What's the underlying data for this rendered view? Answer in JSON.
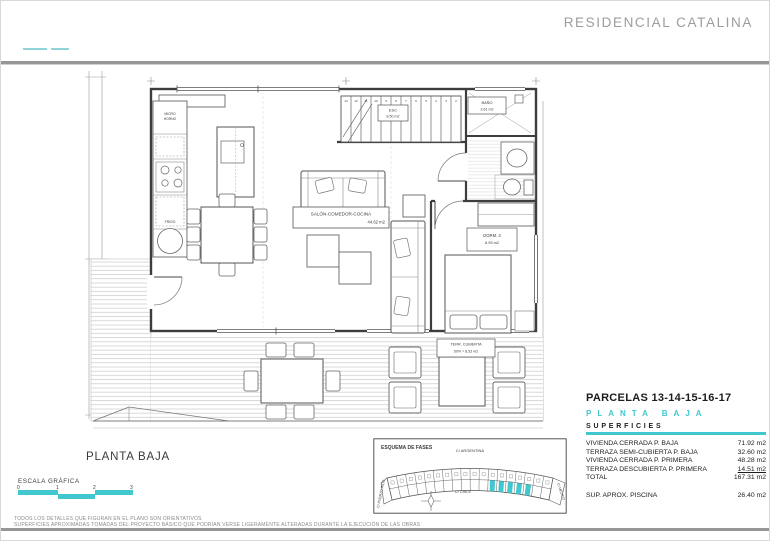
{
  "header": {
    "title": "RESIDENCIAL CATALINA"
  },
  "plan": {
    "salon": {
      "name": "SALÓN-COMEDOR-COCINA",
      "area": "44.62 m2"
    },
    "esc": {
      "name": "ESC",
      "area": "8.50 m2"
    },
    "bano": {
      "name": "BAÑO",
      "area": "3.61 m2"
    },
    "dorm": {
      "name": "DORM. 3",
      "area": "8.93 m2"
    },
    "terraza": {
      "name": "TERR. CUBIERTA",
      "area": "50% = 8.53 m2"
    },
    "micro_line1": "MICRO",
    "micro_line2": "HORNO",
    "frigo": "FRIGO",
    "stair_numbers": [
      "13",
      "12",
      "11",
      "10",
      "9",
      "8",
      "7",
      "6",
      "5",
      "4",
      "3",
      "2"
    ]
  },
  "footer": {
    "plan_title": "PLANTA BAJA",
    "scale_label": "ESCALA GRÁFICA",
    "scale_ticks": [
      "0",
      "1",
      "2",
      "3"
    ]
  },
  "esquema": {
    "title": "ESQUEMA DE FASES",
    "street_top": "C/ ARGENTINA",
    "street_bottom": "C/ CHILE",
    "street_left": "C/ PUERTO RICO",
    "street_right": "C/ MEJICO"
  },
  "summary": {
    "title": "PARCELAS 13-14-15-16-17",
    "subtitle": "PLANTA BAJA",
    "section": "SUPERFICIES",
    "rows": [
      {
        "label": "VIVIENDA CERRADA P. BAJA",
        "value": "71.92 m2"
      },
      {
        "label": "TERRAZA SEMI-CUBIERTA P. BAJA",
        "value": "32.60 m2"
      },
      {
        "label": "VIVIENDA CERRADA P. PRIMERA",
        "value": "48.28 m2"
      },
      {
        "label": "TERRAZA DESCUBIERTA P. PRIMERA",
        "value": "14.51 m2"
      },
      {
        "label": "TOTAL",
        "value": "167.31 m2"
      }
    ],
    "extra_row": {
      "label": "SUP. APROX. PISCINA",
      "value": "26.40 m2"
    }
  },
  "disclaimer": {
    "line1": "TODOS LOS DETALLES QUE FIGURAN EN EL PLANO SON ORIENTATIVOS",
    "line2": "SUPERFICIES APROXIMADAS TOMADAS DEL PROYECTO BÁSICO QUE PODRÍAN VERSE LIGERAMENTE ALTERADAS DURANTE LA EJECUCIÓN DE LAS OBRAS"
  },
  "colors": {
    "accent": "#41C8CE",
    "line": "#4a4a4a",
    "title_gray": "#9c9c9c"
  }
}
